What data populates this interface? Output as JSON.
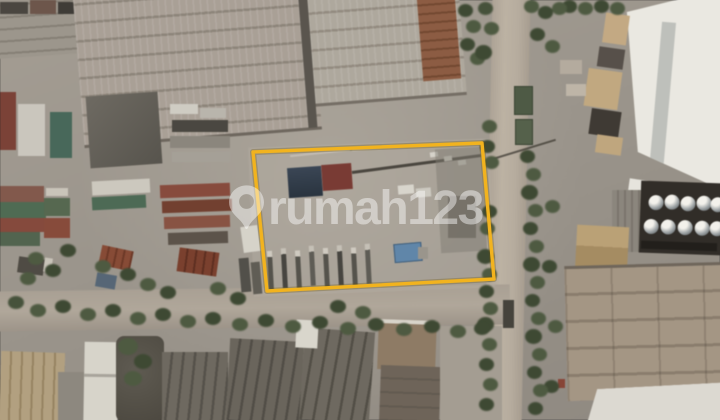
{
  "page": {
    "type": "satellite-aerial-photo",
    "context": "industrial area aerial view with highlighted land plot"
  },
  "watermark": {
    "brand": "rumah123",
    "icon": "map-pin-icon",
    "color": "#FFFFFF",
    "opacity": 0.45
  },
  "boundary": {
    "points": "253,152 482,143 494,279 267,291",
    "color": "#F2B31E",
    "shadow_color": "rgba(110,85,10,0.30)",
    "stroke_width": 3.4
  },
  "scene": {
    "features": [
      "warehouse-roof-northwest",
      "container-yard-west",
      "highlighted-land-plot",
      "containers-on-plot",
      "trailer-row-on-plot",
      "access-road-east",
      "access-road-south",
      "tree-lines",
      "storage-tanks-east",
      "white-roof-building-northeast",
      "warehouse-southeast",
      "rooftops-south"
    ]
  }
}
